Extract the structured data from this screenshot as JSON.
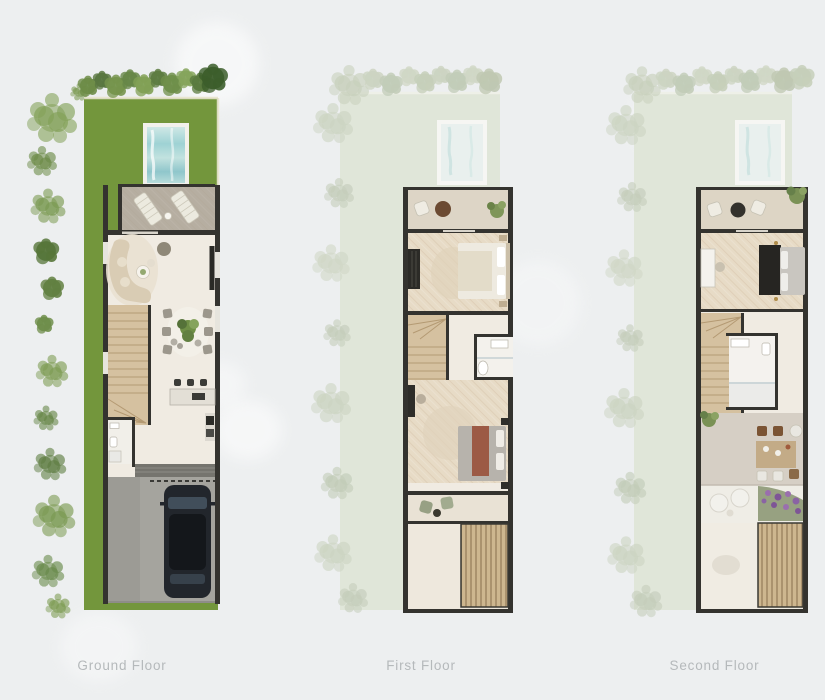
{
  "sheet": {
    "type": "floor-plan-set",
    "unit": "townhouse",
    "background": "#edeff0"
  },
  "plans": [
    {
      "id": "ground-floor",
      "label": "Ground Floor"
    },
    {
      "id": "first-floor",
      "label": "First Floor"
    },
    {
      "id": "second-floor",
      "label": "Second Floor"
    }
  ],
  "colors": {
    "background": "#edeff0",
    "label_text": "#b5b9bb",
    "grass": "#78993f",
    "garden_faded": "#e0e6d9",
    "wall_dark": "#34332f",
    "floor_light": "#f0ebe2",
    "floor_wood": "#e7dbc6",
    "terrace_stone": "#b6aea1",
    "pool_frame": "#f2f1ec",
    "stair_wood": "#d5c1a0",
    "deck_wood": "#cdb68f",
    "driveway": "#a5a49e",
    "car_body": "#22262c",
    "sofa_beige": "#d9ccb4",
    "accent_terracotta": "#9c5a45",
    "flower_purple": "#9a6fae"
  }
}
